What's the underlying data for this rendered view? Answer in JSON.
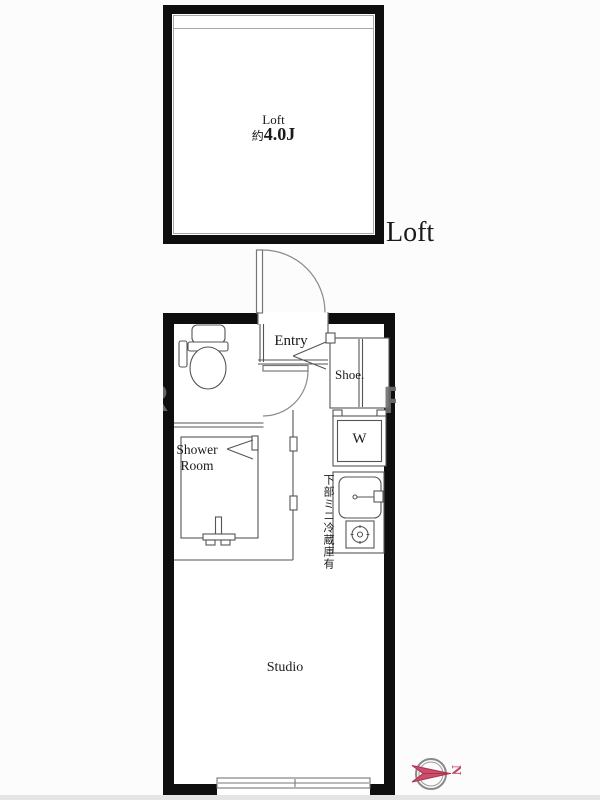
{
  "title": "apartment-floor-plan",
  "loft": {
    "room_label": "Loft",
    "size_prefix": "約",
    "size_value": "4.0J",
    "section_label": "Loft"
  },
  "rooms": {
    "entry": "Entry",
    "shoe_cabinet": "Shoe.",
    "washer": "W",
    "shower_line1": "Shower",
    "shower_line2": "Room",
    "studio": "Studio"
  },
  "notes": {
    "kitchen_note": "下部ミニ冷蔵庫有"
  },
  "compass": {
    "north_label": "N",
    "direction": "north-points-right",
    "color": "#c04060"
  },
  "watermark": {
    "left_fragment": "R",
    "right_fragment": "R"
  },
  "colors": {
    "wall": "#0e0e0e",
    "line": "#555555",
    "text": "#1a1a1a",
    "inner_frame": "#a8a8a8"
  }
}
